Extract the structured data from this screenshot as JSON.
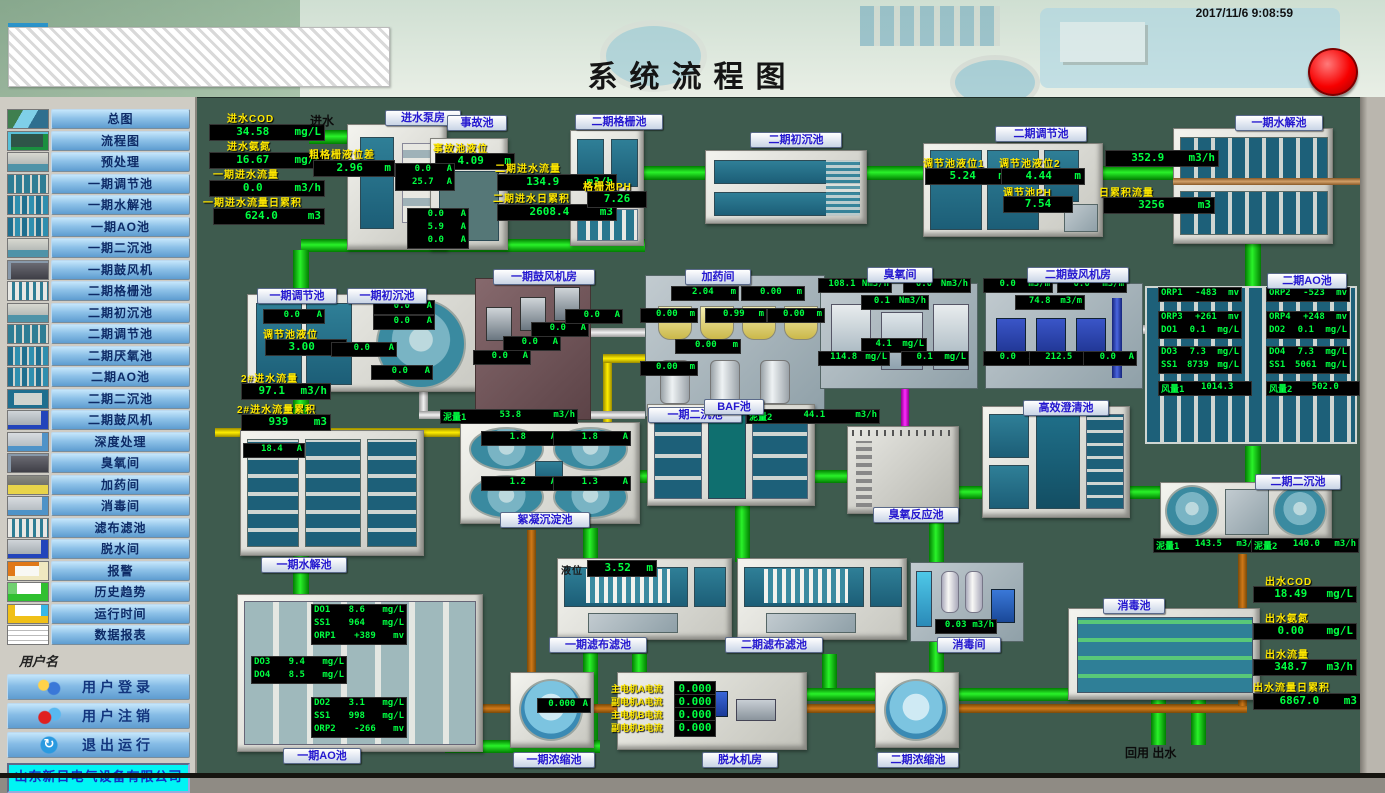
{
  "header": {
    "title": "系统流程图",
    "timestamp": "2017/11/6 9:08:59",
    "alarm_color": "#ff0000"
  },
  "sidebar": {
    "username_label": "用户名",
    "company": "山东新日电气设备有限公司",
    "nav_items": [
      {
        "label": "总图",
        "thumb": "aerial"
      },
      {
        "label": "流程图",
        "thumb": "flow"
      },
      {
        "label": "预处理",
        "thumb": "basin"
      },
      {
        "label": "一期调节池",
        "thumb": "tanks"
      },
      {
        "label": "一期水解池",
        "thumb": "cells"
      },
      {
        "label": "一期AO池",
        "thumb": "cells"
      },
      {
        "label": "一期二沉池",
        "thumb": "basin"
      },
      {
        "label": "一期鼓风机",
        "thumb": "machine"
      },
      {
        "label": "二期格栅池",
        "thumb": "grid"
      },
      {
        "label": "二期初沉池",
        "thumb": "basin"
      },
      {
        "label": "二期调节池",
        "thumb": "tanks"
      },
      {
        "label": "二期厌氧池",
        "thumb": "cells"
      },
      {
        "label": "二期AO池",
        "thumb": "cells"
      },
      {
        "label": "二期二沉池",
        "thumb": "pools"
      },
      {
        "label": "二期鼓风机",
        "thumb": "machblue"
      },
      {
        "label": "深度处理",
        "thumb": "room"
      },
      {
        "label": "臭氧间",
        "thumb": "machine"
      },
      {
        "label": "加药间",
        "thumb": "hopper"
      },
      {
        "label": "消毒间",
        "thumb": "room"
      },
      {
        "label": "滤布滤池",
        "thumb": "grid"
      },
      {
        "label": "脱水间",
        "thumb": "machblue"
      },
      {
        "label": "报警",
        "thumb": "alarm"
      },
      {
        "label": "历史趋势",
        "thumb": "trend"
      },
      {
        "label": "运行时间",
        "thumb": "runtime"
      },
      {
        "label": "数据报表",
        "thumb": "report"
      }
    ],
    "user_buttons": [
      {
        "label": "用户登录",
        "icon": "user-login-icon",
        "style": "ic-login"
      },
      {
        "label": "用户注销",
        "icon": "user-logout-icon",
        "style": "ic-logout"
      },
      {
        "label": "退出运行",
        "icon": "exit-icon",
        "style": "ic-exit"
      }
    ]
  },
  "canvas": {
    "texts": [
      {
        "id": "inflow",
        "text": "进水"
      },
      {
        "id": "outflow",
        "text": "回用  出水"
      }
    ],
    "station_labels": [
      {
        "id": "pump_house",
        "text": "进水泵房"
      },
      {
        "id": "accident",
        "text": "事故池"
      },
      {
        "id": "grid2",
        "text": "二期格栅池"
      },
      {
        "id": "presed2",
        "text": "二期初沉池"
      },
      {
        "id": "tank2",
        "text": "二期调节池"
      },
      {
        "id": "hydro_top",
        "text": "一期水解池"
      },
      {
        "id": "tank1",
        "text": "一期调节池"
      },
      {
        "id": "presed1",
        "text": "一期初沉池"
      },
      {
        "id": "blower1",
        "text": "一期鼓风机房"
      },
      {
        "id": "dosing",
        "text": "加药间"
      },
      {
        "id": "ozone",
        "text": "臭氧间"
      },
      {
        "id": "blower2",
        "text": "二期鼓风机房"
      },
      {
        "id": "ao2",
        "text": "二期AO池"
      },
      {
        "id": "sed1",
        "text": "一期二沉池"
      },
      {
        "id": "baf",
        "text": "BAF池"
      },
      {
        "id": "floc",
        "text": "絮凝沉淀池"
      },
      {
        "id": "ozone_tank",
        "text": "臭氧反应池"
      },
      {
        "id": "clarifier",
        "text": "高效澄清池"
      },
      {
        "id": "sed2",
        "text": "二期二沉池"
      },
      {
        "id": "disinf_pool",
        "text": "消毒池"
      },
      {
        "id": "filt1",
        "text": "一期滤布滤池"
      },
      {
        "id": "filt2",
        "text": "二期滤布滤池"
      },
      {
        "id": "disinf_room",
        "text": "消毒间"
      },
      {
        "id": "hydro_bottom",
        "text": "一期水解池"
      },
      {
        "id": "ao1",
        "text": "一期AO池"
      },
      {
        "id": "thick1",
        "text": "一期浓缩池"
      },
      {
        "id": "dewater",
        "text": "脱水机房"
      },
      {
        "id": "thick2",
        "text": "二期浓缩池"
      }
    ],
    "metrics": [
      {
        "id": "in_cod",
        "label": "进水COD",
        "value": "34.58",
        "unit": "mg/L"
      },
      {
        "id": "in_nh3",
        "label": "进水氨氮",
        "value": "16.67",
        "unit": "mg/L"
      },
      {
        "id": "in_flow1",
        "label": "一期进水流量",
        "value": "0.0",
        "unit": "m3/h"
      },
      {
        "id": "in_total1",
        "label": "一期进水流量日累积",
        "value": "624.0",
        "unit": "m3"
      },
      {
        "id": "grid_diff",
        "label": "粗格栅液位差",
        "value": "2.96",
        "unit": "m"
      },
      {
        "id": "acc_level",
        "label": "事故池液位",
        "value": "4.09",
        "unit": "m"
      },
      {
        "id": "in_flow2",
        "label": "二期进水流量",
        "value": "134.9",
        "unit": "m3/h"
      },
      {
        "id": "in_total2",
        "label": "二期进水日累积",
        "value": "2608.4",
        "unit": "m3"
      },
      {
        "id": "grid_ph",
        "label": "格栅池PH",
        "value": "7.26",
        "unit": ""
      },
      {
        "id": "t2_lvl1",
        "label": "调节池液位1",
        "value": "5.24",
        "unit": "m"
      },
      {
        "id": "t2_lvl2",
        "label": "调节池液位2",
        "value": "4.44",
        "unit": "m"
      },
      {
        "id": "t2_ph",
        "label": "调节池PH",
        "value": "7.54",
        "unit": ""
      },
      {
        "id": "hydro_flow",
        "label": "",
        "value": "352.9",
        "unit": "m3/h"
      },
      {
        "id": "hydro_total",
        "label": "日累积流量",
        "value": "3256",
        "unit": "m3"
      },
      {
        "id": "p2_flow",
        "label": "2#进水流量",
        "value": "97.1",
        "unit": "m3/h"
      },
      {
        "id": "p2_total",
        "label": "2#进水流量累积",
        "value": "939",
        "unit": "m3"
      },
      {
        "id": "t1_lvl",
        "label": "调节池液位",
        "value": "3.00",
        "unit": "m"
      },
      {
        "id": "filt_lvl",
        "label": "液位",
        "value": "3.52",
        "unit": "m"
      },
      {
        "id": "out_cod",
        "label": "出水COD",
        "value": "18.49",
        "unit": "mg/L"
      },
      {
        "id": "out_nh3",
        "label": "出水氨氮",
        "value": "0.00",
        "unit": "mg/L"
      },
      {
        "id": "out_flow",
        "label": "出水流量",
        "value": "348.7",
        "unit": "m3/h"
      },
      {
        "id": "out_total",
        "label": "出水流量日累积",
        "value": "6867.0",
        "unit": "m3"
      },
      {
        "id": "motor_a1",
        "label": "主电机A电流",
        "value": "0.000",
        "unit": ""
      },
      {
        "id": "motor_a2",
        "label": "副电机A电流",
        "value": "0.000",
        "unit": ""
      },
      {
        "id": "motor_b1",
        "label": "主电机B电流",
        "value": "0.000",
        "unit": ""
      },
      {
        "id": "motor_b2",
        "label": "副电机B电流",
        "value": "0.000",
        "unit": ""
      }
    ],
    "readouts": [
      {
        "id": "pump_top",
        "rows": [
          {
            "l": "",
            "v": "0.0",
            "u": "A"
          },
          {
            "l": "",
            "v": "25.7",
            "u": "A"
          }
        ]
      },
      {
        "id": "pump_side",
        "rows": [
          {
            "l": "",
            "v": "0.0",
            "u": "A"
          },
          {
            "l": "",
            "v": "5.9",
            "u": "A"
          },
          {
            "l": "",
            "v": "0.0",
            "u": "A"
          }
        ]
      },
      {
        "id": "t1_amp",
        "rows": [
          {
            "l": "",
            "v": "0.0",
            "u": "A"
          }
        ]
      },
      {
        "id": "ps1_a1",
        "rows": [
          {
            "l": "",
            "v": "0.0",
            "u": "A"
          }
        ]
      },
      {
        "id": "ps1_a2",
        "rows": [
          {
            "l": "",
            "v": "0.0",
            "u": "A"
          }
        ]
      },
      {
        "id": "ps1_a3",
        "rows": [
          {
            "l": "",
            "v": "0.0",
            "u": "A"
          }
        ]
      },
      {
        "id": "ps1_a4",
        "rows": [
          {
            "l": "",
            "v": "0.0",
            "u": "A"
          }
        ]
      },
      {
        "id": "bl1_a1",
        "rows": [
          {
            "l": "",
            "v": "0.0",
            "u": "A"
          }
        ]
      },
      {
        "id": "bl1_a2",
        "rows": [
          {
            "l": "",
            "v": "0.0",
            "u": "A"
          }
        ]
      },
      {
        "id": "bl1_a3",
        "rows": [
          {
            "l": "",
            "v": "0.0",
            "u": "A"
          }
        ]
      },
      {
        "id": "bl1_a4",
        "rows": [
          {
            "l": "",
            "v": "0.0",
            "u": "A"
          }
        ]
      },
      {
        "id": "dos1",
        "rows": [
          {
            "l": "",
            "v": "2.04",
            "u": "m"
          }
        ]
      },
      {
        "id": "dos2",
        "rows": [
          {
            "l": "",
            "v": "0.00",
            "u": "m"
          }
        ]
      },
      {
        "id": "dos3",
        "rows": [
          {
            "l": "",
            "v": "0.00",
            "u": "m"
          }
        ]
      },
      {
        "id": "dos4",
        "rows": [
          {
            "l": "",
            "v": "0.99",
            "u": "m"
          }
        ]
      },
      {
        "id": "dos5",
        "rows": [
          {
            "l": "",
            "v": "0.00",
            "u": "m"
          }
        ]
      },
      {
        "id": "dos6",
        "rows": [
          {
            "l": "",
            "v": "0.00",
            "u": "m"
          }
        ]
      },
      {
        "id": "dos7",
        "rows": [
          {
            "l": "",
            "v": "0.00",
            "u": "m"
          }
        ]
      },
      {
        "id": "oz1",
        "rows": [
          {
            "l": "",
            "v": "108.1",
            "u": "Nm3/h"
          }
        ]
      },
      {
        "id": "oz2",
        "rows": [
          {
            "l": "",
            "v": "0.0",
            "u": "Nm3/h"
          }
        ]
      },
      {
        "id": "oz3",
        "rows": [
          {
            "l": "",
            "v": "0.1",
            "u": "Nm3/h"
          }
        ]
      },
      {
        "id": "oz4",
        "rows": [
          {
            "l": "",
            "v": "4.1",
            "u": "mg/L"
          }
        ]
      },
      {
        "id": "oz5",
        "rows": [
          {
            "l": "",
            "v": "114.8",
            "u": "mg/L"
          }
        ]
      },
      {
        "id": "oz6",
        "rows": [
          {
            "l": "",
            "v": "0.1",
            "u": "mg/L"
          }
        ]
      },
      {
        "id": "bl2_f1",
        "rows": [
          {
            "l": "",
            "v": "0.0",
            "u": "m3/m"
          }
        ]
      },
      {
        "id": "bl2_f2",
        "rows": [
          {
            "l": "",
            "v": "0.0",
            "u": "m3/m"
          }
        ]
      },
      {
        "id": "bl2_f3",
        "rows": [
          {
            "l": "",
            "v": "74.8",
            "u": "m3/m"
          }
        ]
      },
      {
        "id": "bl2_a1",
        "rows": [
          {
            "l": "",
            "v": "0.0",
            "u": "A"
          }
        ]
      },
      {
        "id": "bl2_a2",
        "rows": [
          {
            "l": "",
            "v": "212.5",
            "u": "A"
          }
        ]
      },
      {
        "id": "bl2_a3",
        "rows": [
          {
            "l": "",
            "v": "0.0",
            "u": "A"
          }
        ]
      },
      {
        "id": "ao2_orp1",
        "rows": [
          {
            "l": "ORP1",
            "v": "-483",
            "u": "mv"
          }
        ]
      },
      {
        "id": "ao2_orp2",
        "rows": [
          {
            "l": "ORP2",
            "v": "-523",
            "u": "mv"
          }
        ]
      },
      {
        "id": "ao2_g3",
        "rows": [
          {
            "l": "ORP3",
            "v": "+261",
            "u": "mv"
          },
          {
            "l": "DO1",
            "v": "0.1",
            "u": "mg/L"
          }
        ]
      },
      {
        "id": "ao2_g4",
        "rows": [
          {
            "l": "ORP4",
            "v": "+248",
            "u": "mv"
          },
          {
            "l": "DO2",
            "v": "0.1",
            "u": "mg/L"
          }
        ]
      },
      {
        "id": "ao2_g5",
        "rows": [
          {
            "l": "DO3",
            "v": "7.3",
            "u": "mg/L"
          },
          {
            "l": "SS1",
            "v": "8739",
            "u": "mg/L"
          }
        ]
      },
      {
        "id": "ao2_g6",
        "rows": [
          {
            "l": "DO4",
            "v": "7.3",
            "u": "mg/L"
          },
          {
            "l": "SS1",
            "v": "5061",
            "u": "mg/L"
          }
        ]
      },
      {
        "id": "ao2_f1",
        "rows": [
          {
            "l": "风量1",
            "v": "1014.3",
            "u": ""
          }
        ]
      },
      {
        "id": "ao2_f2",
        "rows": [
          {
            "l": "风量2",
            "v": "502.0",
            "u": ""
          }
        ]
      },
      {
        "id": "sed1_ni1",
        "rows": [
          {
            "l": "泥量1",
            "v": "53.8",
            "u": "m3/h"
          }
        ]
      },
      {
        "id": "sed1_ni2",
        "rows": [
          {
            "l": "泥量2",
            "v": "44.1",
            "u": "m3/h"
          }
        ]
      },
      {
        "id": "sed1_a1",
        "rows": [
          {
            "l": "",
            "v": "1.8",
            "u": "A"
          }
        ]
      },
      {
        "id": "sed1_a2",
        "rows": [
          {
            "l": "",
            "v": "1.8",
            "u": "A"
          }
        ]
      },
      {
        "id": "sed1_a3",
        "rows": [
          {
            "l": "",
            "v": "1.2",
            "u": "A"
          }
        ]
      },
      {
        "id": "sed1_a4",
        "rows": [
          {
            "l": "",
            "v": "1.3",
            "u": "A"
          }
        ]
      },
      {
        "id": "hydro1_amp",
        "rows": [
          {
            "l": "",
            "v": "18.4",
            "u": "A"
          }
        ]
      },
      {
        "id": "ao1_g1",
        "rows": [
          {
            "l": "DO1",
            "v": "8.6",
            "u": "mg/L"
          },
          {
            "l": "SS1",
            "v": "964",
            "u": "mg/L"
          },
          {
            "l": "ORP1",
            "v": "+389",
            "u": "mv"
          }
        ]
      },
      {
        "id": "ao1_g2",
        "rows": [
          {
            "l": "DO3",
            "v": "9.4",
            "u": "mg/L"
          },
          {
            "l": "DO4",
            "v": "8.5",
            "u": "mg/L"
          }
        ]
      },
      {
        "id": "ao1_g3",
        "rows": [
          {
            "l": "DO2",
            "v": "3.1",
            "u": "mg/L"
          },
          {
            "l": "SS1",
            "v": "998",
            "u": "mg/L"
          },
          {
            "l": "ORP2",
            "v": "-266",
            "u": "mv"
          }
        ]
      },
      {
        "id": "sed2_ni1",
        "rows": [
          {
            "l": "泥量1",
            "v": "143.5",
            "u": "m3/h"
          }
        ]
      },
      {
        "id": "sed2_ni2",
        "rows": [
          {
            "l": "泥量2",
            "v": "140.0",
            "u": "m3/h"
          }
        ]
      },
      {
        "id": "thick1_amp",
        "rows": [
          {
            "l": "",
            "v": "0.000",
            "u": "A"
          }
        ]
      },
      {
        "id": "disinf_flow",
        "rows": [
          {
            "l": "",
            "v": "0.03",
            "u": "m3/h"
          }
        ]
      }
    ]
  }
}
